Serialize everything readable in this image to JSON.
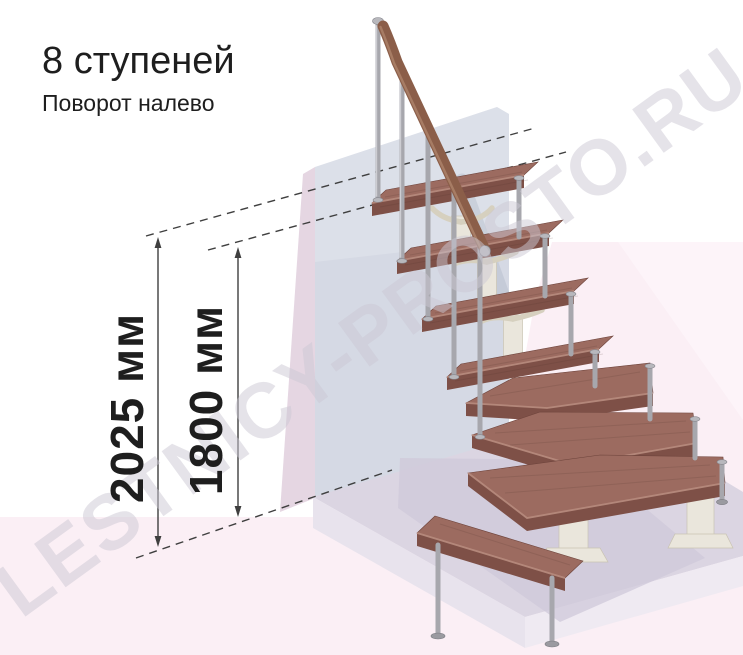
{
  "page": {
    "title": "8 ступеней",
    "subtitle": "Поворот налево"
  },
  "stairs": {
    "step_count": 8,
    "turn_direction": "налево"
  },
  "dimensions": {
    "total_height": {
      "text": "2025 мм",
      "value": 2025,
      "unit": "мм"
    },
    "inner_height": {
      "text": "1800 мм",
      "value": 1800,
      "unit": "мм"
    }
  },
  "watermark": {
    "text": "LESTNICY-PROSTO.RU"
  },
  "colors": {
    "ink": "#1e1e1e",
    "dim_line": "#3f3f3f",
    "wall": "#d5d9e4",
    "wall_side": "#e5d6e2",
    "wall_shadow": "#aab1c4",
    "floor_pink": "#fbeff5",
    "slab_top": "#dbd5e2",
    "slab_front": "#e8e3ed",
    "slab_front_right": "#efeaf2",
    "slab_shadow": "#cfc8d9",
    "tread_top": "#9c6b60",
    "tread_front": "#7e5047",
    "tread_side": "#8a5a50",
    "tread_edge": "#b98d80",
    "rail_wood": "#8b5e49",
    "rail_light": "#ab8168",
    "metal": "#a7a7ad",
    "metal_cap": "#b8b8bd",
    "metal_dark": "#85858c",
    "cream": "#eae6dc",
    "cream_dark": "#d6d0bf",
    "watermark_color": "rgba(203,199,211,0.5)"
  }
}
